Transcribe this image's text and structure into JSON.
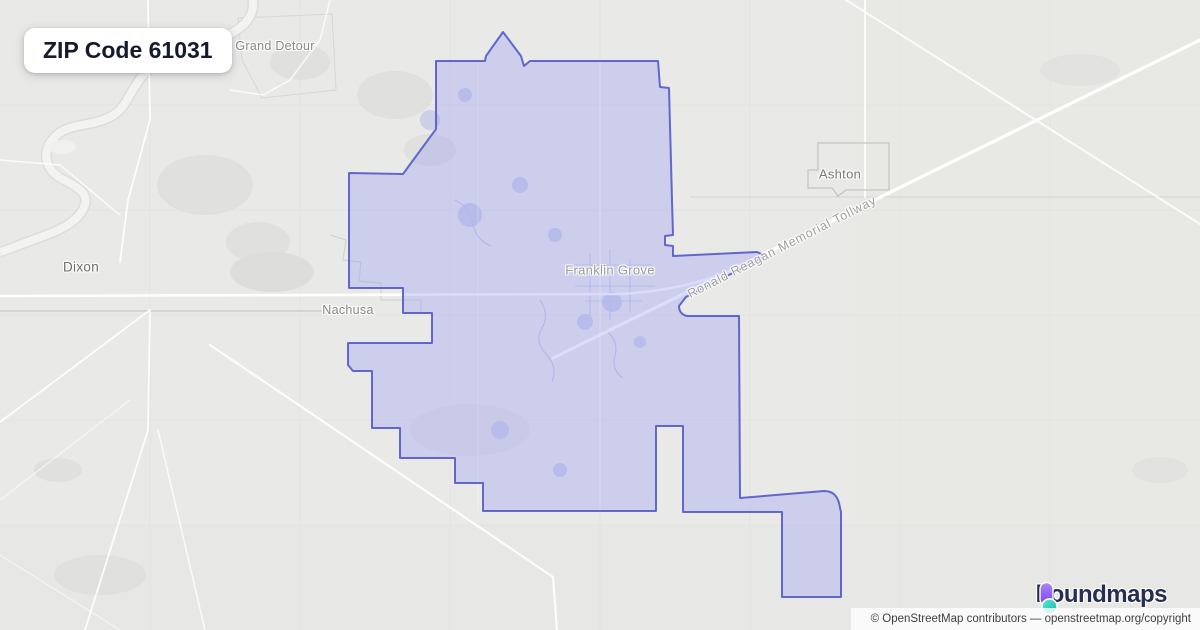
{
  "badge": {
    "label": "ZIP Code 61031"
  },
  "map": {
    "place_labels": [
      {
        "id": "grand-detour",
        "text": "Grand Detour",
        "x": 275,
        "y": 46,
        "size": 12.5,
        "color": "#8a8a8a"
      },
      {
        "id": "dixon",
        "text": "Dixon",
        "x": 81,
        "y": 267,
        "size": 13.5,
        "color": "#6e6e6e"
      },
      {
        "id": "nachusa",
        "text": "Nachusa",
        "x": 348,
        "y": 310,
        "size": 12.5,
        "color": "#8a8a8a"
      },
      {
        "id": "franklin-grove",
        "text": "Franklin Grove",
        "x": 610,
        "y": 270,
        "size": 13,
        "color": "#9b9b9b"
      },
      {
        "id": "ashton",
        "text": "Ashton",
        "x": 840,
        "y": 174,
        "size": 13,
        "color": "#7a7a7a"
      }
    ],
    "road_labels": [
      {
        "id": "tollway",
        "text": "Ronald Reagan Memorial Tollway",
        "x": 782,
        "y": 247,
        "rotation": -27,
        "size": 12.5
      }
    ],
    "colors": {
      "background": "#e9e9e7",
      "zip_fill": "#8e96f7",
      "zip_fill_opacity": "0.32",
      "zip_boundary": "#5157c8",
      "road": "#ffffff"
    }
  },
  "logo": {
    "text": "boundmaps",
    "colors": {
      "purple_top": "#a78bfa",
      "purple_bottom": "#7c3aed",
      "teal_top": "#5eead4",
      "teal_bottom": "#14b8a6",
      "text": "#262e52"
    }
  },
  "attribution": {
    "text": "© OpenStreetMap contributors — openstreetmap.org/copyright"
  }
}
